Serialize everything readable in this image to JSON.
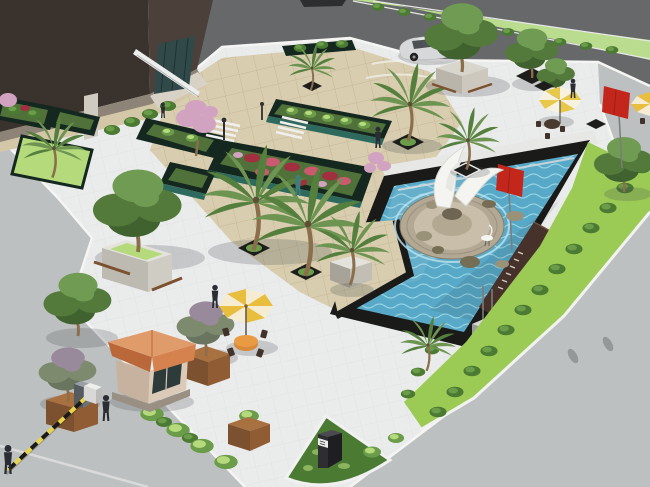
{
  "title": "Aerial 3D architectural rendering of a landscaped entry plaza with fountain pool, palm trees, flower beds and gate house",
  "scene": {
    "type": "architectural-3d-rendering",
    "view": "aerial oblique",
    "setting": "corporate entry plaza bordered by roads, with ornamental pool and planting"
  },
  "labels": {
    "ground": "Roads and concrete paving",
    "building": "Dark brown building with glass entrance and white canopy",
    "building_planters": "Raised planters and lawn bed at building base",
    "plaza": "Beige tiled pedestrian plaza",
    "pool": "Ornamental pool with rippled blue water and black coping",
    "fountain": "Round stone fountain base with rocks and white sail sculpture",
    "crane_bird": "White crane figure",
    "signage_wall": "Dark brown signage wall with metal lettering",
    "red_flag": "Red flag on pole",
    "banner": "Red banner on pole",
    "pedestal": "Concrete pedestal with flag poles",
    "lawn": "Lawn strip with clipped shrub rows",
    "flower_beds": "Raised flower beds with red flowers and shrubs",
    "palms": "Palm trees in tree pits and planters",
    "trees": "Ornamental trees in planters",
    "furniture": "Parasols, seating, gate house, barrier and signs",
    "umbrella_plaza": "Orange parasol with table and chairs",
    "umbrella_upper": "Striped parasol with seating",
    "guard_house": "Gate house with terracotta hip roof",
    "trash_bin": "Waste bin",
    "barrier": "Black and yellow boom barrier",
    "corner_bed": "Quarter-round grass bed with entry sign monument",
    "sign_monument": "Dark entry sign monument with white band",
    "car": "Silver parked car",
    "median": "Planted road median",
    "people": "Pedestrian figures",
    "blossom_tree": "Pink blossom tree"
  },
  "inventory": {
    "palm_trees": 8,
    "ornamental_trees": 7,
    "parasols": 3,
    "pedestrians": 7,
    "flower_beds": 5,
    "flag_poles": 2,
    "pedestals": 2,
    "vehicles": 2
  },
  "colors": {
    "road_dark": "#66686a",
    "road_light": "#bdc0c1",
    "sidewalk": "#eaebeb",
    "curb": "#f5f5f3",
    "median": "#b9dc8e",
    "plaza_tile": "#d8cdaf",
    "plaza_line": "#c6b896",
    "path_tan": "#d3c7a8",
    "b_front": "#3a322d",
    "b_side": "#4b403a",
    "b_base": "#8d8376",
    "pillar": "#d0cbc1",
    "glass": "#32494a",
    "canopy": "#eceded",
    "pool_border": "#1a1a19",
    "pool_rim": "#e7e8e6",
    "water": "#58a9c7",
    "ripple": "#94d2e2",
    "f_ring": "#b2a893",
    "f_inner": "#c8bea9",
    "rock": "#9a9278",
    "rock_d": "#766d55",
    "sculpt": "#f4f4f1",
    "wallb": "#46322a",
    "flag": "#c3271c",
    "ped1": "#d6d6d4",
    "ped2": "#9b9b99",
    "ped3": "#bababa",
    "pole": "#7c7c7a",
    "lawn": "#9ccb55",
    "lawn_b": "#b5da7c",
    "bush": "#4b7a33",
    "bush_hi": "#6b9c49",
    "palm1": "#6e9452",
    "palm2": "#547f3d",
    "trunk": "#8b6f4c",
    "tg1": "#53793b",
    "tg2": "#6f9b52",
    "tg3": "#40622f",
    "tm1": "#7d8a6e",
    "tm2": "#98899b",
    "blossom": "#d2a3c0",
    "fl_red": "#a22f3f",
    "fl_red2": "#ca5a6e",
    "bed_glass": "#2d6a5d",
    "bed_dark": "#152820",
    "bed_soil": "#51713a",
    "u_y1": "#e9bd3e",
    "u_y2": "#f6ecd2",
    "u_c1": "#e8c84a",
    "u_c2": "#f7f2df",
    "tbl": "#d8893a",
    "chair": "#42332a",
    "g_roof": "#d5824e",
    "g_roof2": "#ba683a",
    "g_wall": "#dbcab7",
    "g_wall2": "#c6b29e",
    "window": "#2e3b3b",
    "person": "#2b2d34",
    "teal": "#3f7d7a",
    "car": "#d6d8d9",
    "car_dk": "#343a3e",
    "wood": "#7c5130",
    "wood2": "#a8713f",
    "planterW": "#e4e2dc",
    "pit": "#1d1d1b",
    "sign_dk": "#2e2e32",
    "sign_band": "#e9e9e7"
  }
}
